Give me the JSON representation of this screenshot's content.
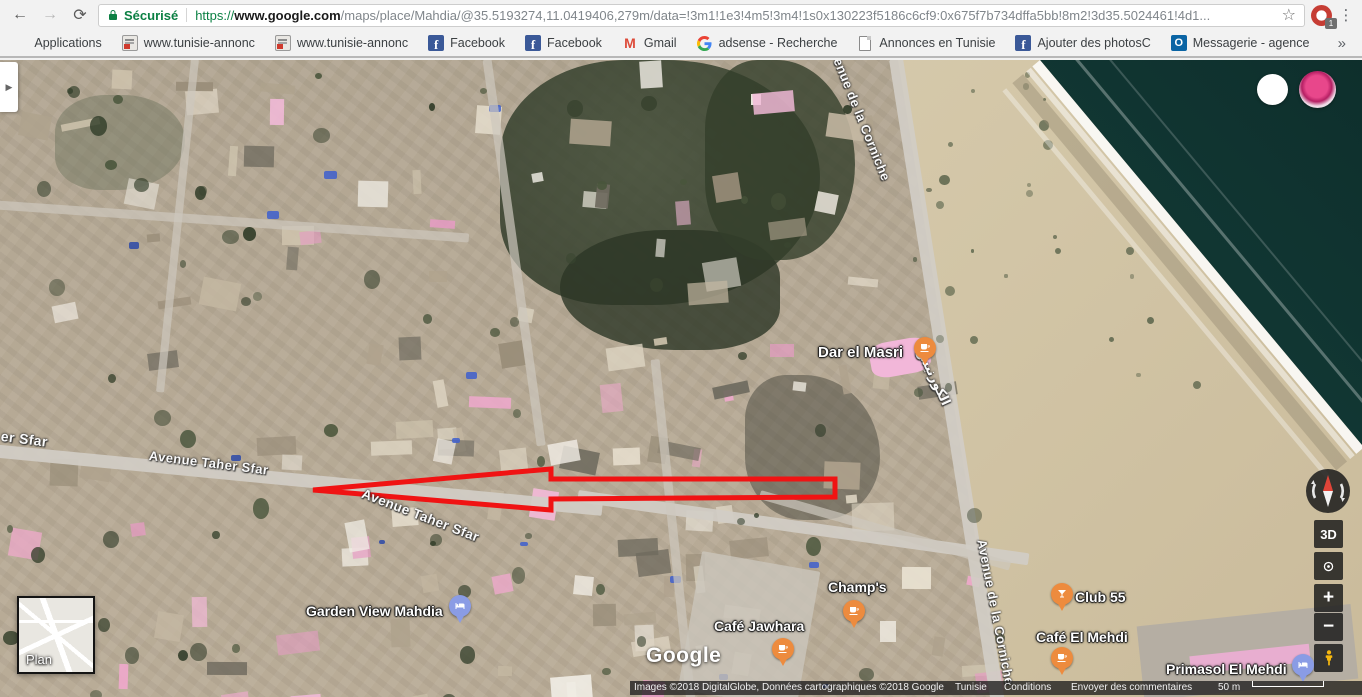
{
  "icons": {
    "back": "←",
    "forward": "→",
    "refresh": "⟳",
    "star": "☆",
    "menu": "⋮",
    "chevron": "»",
    "expand": "▶",
    "fb_glyph": "f",
    "gmail_glyph": "M",
    "outlook_glyph": "O"
  },
  "colors": {
    "secure_green": "#0b8043",
    "cafe_pin": "#ed8b3e",
    "lodging_pin": "#8a9ce5",
    "annotation_red": "#f01313"
  },
  "browser": {
    "security_label": "Sécurisé",
    "url_scheme": "https://",
    "url_host": "www.google.com",
    "url_path": "/maps/place/Mahdia/@35.5193274,11.0419406,279m/data=!3m1!1e3!4m5!3m4!1s0x130223f5186c6cf9:0x675f7b734dffa5bb!8m2!3d35.5024461!4d1...",
    "profile_badge": "1",
    "bookmarks": [
      {
        "label": "Applications",
        "icon": "apps-grid-icon"
      },
      {
        "label": "www.tunisie-annonc",
        "icon": "site-favicon"
      },
      {
        "label": "www.tunisie-annonc",
        "icon": "site-favicon"
      },
      {
        "label": "Facebook",
        "icon": "facebook-icon"
      },
      {
        "label": "Facebook",
        "icon": "facebook-icon"
      },
      {
        "label": "Gmail",
        "icon": "gmail-icon"
      },
      {
        "label": "adsense - Recherche",
        "icon": "google-icon"
      },
      {
        "label": "Annonces en Tunisie",
        "icon": "page-icon"
      },
      {
        "label": "Ajouter des photosC",
        "icon": "facebook-icon"
      },
      {
        "label": "Messagerie - agence",
        "icon": "outlook-icon"
      }
    ]
  },
  "map": {
    "street_labels": [
      {
        "text": "er Sfar"
      },
      {
        "text": "Avenue Taher Sfar"
      },
      {
        "text": "Avenue Taher Sfar"
      },
      {
        "text": "Avenue de la Corniche"
      },
      {
        "text": "Avenue de la Corniche"
      },
      {
        "text": "الكورنيش"
      }
    ],
    "places": [
      {
        "name": "Dar el Masri",
        "type": "cafe"
      },
      {
        "name": "Garden View Mahdia",
        "type": "lodging"
      },
      {
        "name": "Café Jawhara",
        "type": "cafe"
      },
      {
        "name": "Champ's",
        "type": "cafe"
      },
      {
        "name": "Club 55",
        "type": "bar"
      },
      {
        "name": "Café El Mehdi",
        "type": "cafe"
      },
      {
        "name": "Primasol El Mehdi",
        "type": "lodging"
      }
    ],
    "logo": "Google",
    "minimap_label": "Plan",
    "controls": {
      "tilt": "3D",
      "zoom_in": "+",
      "zoom_out": "−"
    },
    "attribution": {
      "imagery": "Images ©2018 DigitalGlobe, Données cartographiques ©2018 Google",
      "region": "Tunisie",
      "terms": "Conditions",
      "feedback": "Envoyer des commentaires",
      "scale": "50 m"
    }
  }
}
